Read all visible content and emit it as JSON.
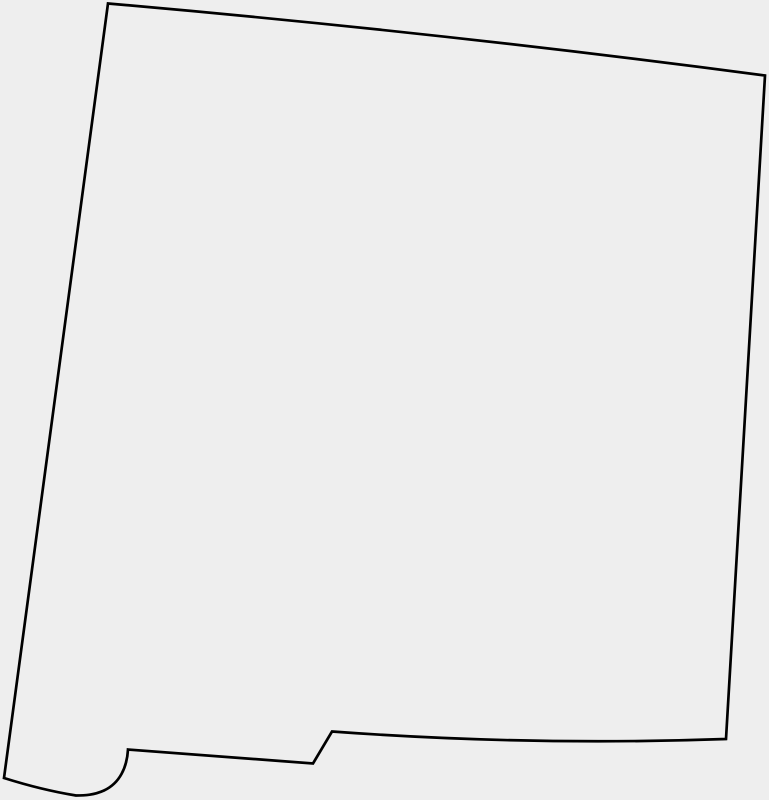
{
  "map": {
    "region": "New Mexico",
    "kind": "blank-state-outline-silhouette",
    "canvas": {
      "width": 769,
      "height": 800
    },
    "colors": {
      "background": "#eeeeee",
      "outline": "#000000",
      "fill": "none"
    },
    "outline_stroke_width": 2.7,
    "outline_path": "M 108 3.5 Q 436 32 765 75.5 L 726 739 Q 530 746 332 731.5 L 313 763.5 L 128 749.5 C 127 767 120 783 104 790.5 C 94 795 85 795.5 76 795.5 Q 42 790 4 778 Z"
  }
}
